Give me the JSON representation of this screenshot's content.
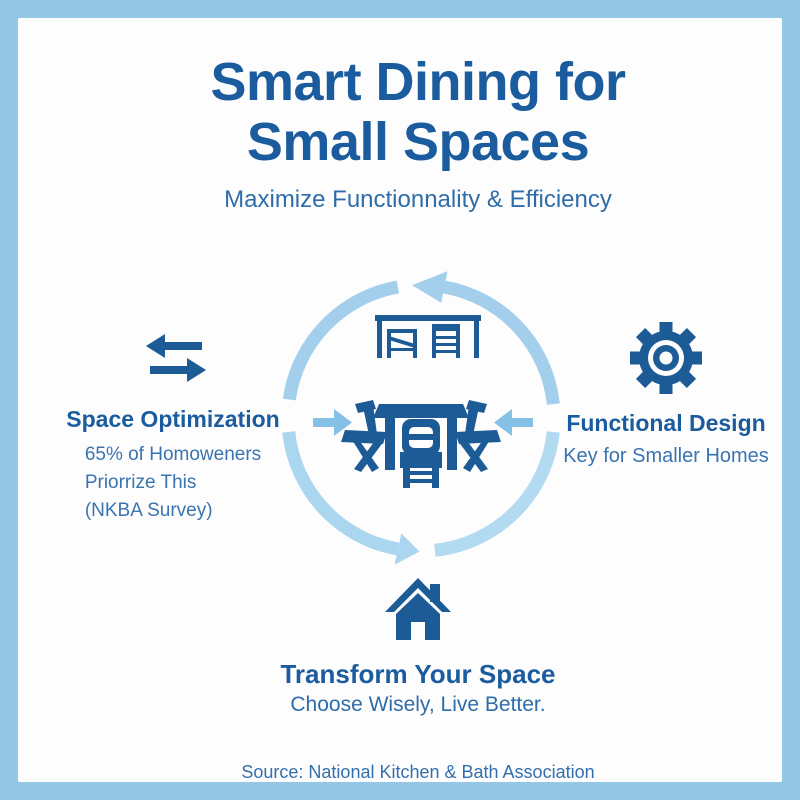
{
  "header": {
    "title_line1": "Smart Dining for",
    "title_line2": "Small Spaces",
    "subtitle": "Maximize Functionnality & Efficiency"
  },
  "left_section": {
    "icon": "swap-arrows-icon",
    "title": "Space Optimization",
    "lines": [
      "65% of Homoweners",
      "Priorrize This",
      "(NKBA Survey)"
    ]
  },
  "right_section": {
    "icon": "gear-icon",
    "title": "Functional Design",
    "subtitle": "Key for Smaller Homes"
  },
  "center_diagram": {
    "description": "counterclockwise cycle of arrows with inward arrows at left and right",
    "icons": [
      "bar-table-with-stools",
      "folding-table-with-chairs"
    ]
  },
  "bottom_section": {
    "icon": "house-icon",
    "title": "Transform Your Space",
    "subtitle": "Choose Wisely, Live Better."
  },
  "footer": {
    "source": "Source: National Kitchen & Bath Association"
  },
  "colors": {
    "frame_border": "#93c7e5",
    "background": "#fdfdfe",
    "icon_blue": "#1d5b97",
    "heading_blue": "#1b5c9e",
    "body_blue": "#3a74b0",
    "arc_blue_top": "#a3cfec",
    "arc_blue_bottom": "#b2dbf2",
    "inward_arrow_blue": "#85c1e6"
  }
}
